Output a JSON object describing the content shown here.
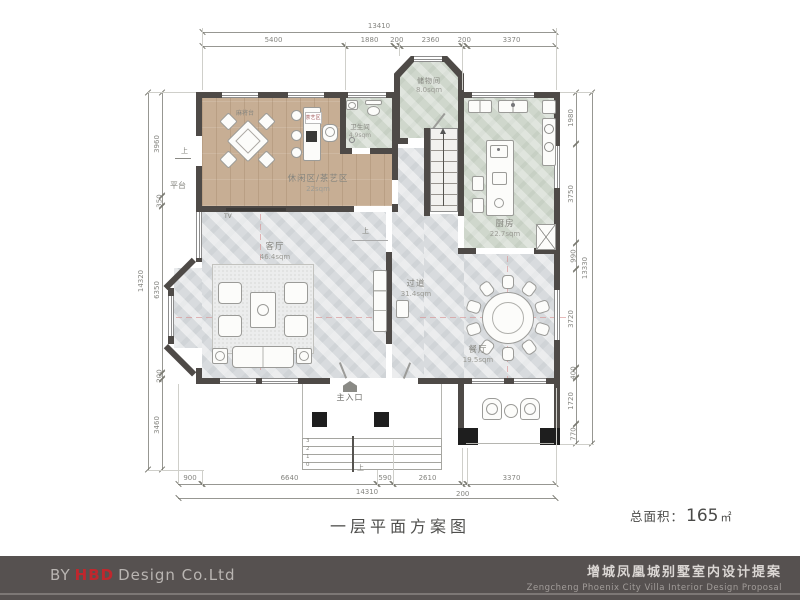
{
  "plan": {
    "title": "一层平面方案图",
    "total_area": {
      "label": "总面积：",
      "value": "165",
      "unit": "㎡"
    },
    "rooms": {
      "leisure": {
        "name": "休闲区/茶艺区",
        "area": "22sqm"
      },
      "storage": {
        "name": "储物间",
        "area": "8.0sqm"
      },
      "bathroom": {
        "name": "卫生间",
        "area": "4.9sqm"
      },
      "kitchen": {
        "name": "厨房",
        "area": "22.7sqm"
      },
      "living": {
        "name": "客厅",
        "area": "46.4sqm"
      },
      "hallway": {
        "name": "过道",
        "area": "31.4sqm"
      },
      "dining": {
        "name": "餐厅",
        "area": "19.5sqm"
      }
    },
    "labels": {
      "main_entrance": "主入口",
      "platform": "平台",
      "up": "上",
      "tv": "TV",
      "mahjong_table": "麻将台",
      "tea_bar": "茶艺区",
      "steps": [
        "3",
        "2",
        "1",
        "0"
      ]
    },
    "dimensions": {
      "top_total": "13410",
      "top": [
        "5400",
        "1880",
        "200",
        "2360",
        "200",
        "3370"
      ],
      "bottom": [
        "900",
        "6640",
        "590",
        "2610",
        "200",
        "3370"
      ],
      "bottom_total": "14310",
      "left": [
        "3960",
        "350",
        "6350",
        "200",
        "3460"
      ],
      "left_total": "14320",
      "right": [
        "1980",
        "3750",
        "990",
        "3720",
        "400",
        "1720",
        "770"
      ],
      "right_total": "13330"
    },
    "colors": {
      "wall": "#4e4a47",
      "wood_floor": "#c7ae94",
      "marble_green": "#cfd7cc",
      "marble_gray": "#d8dbde",
      "accent_red": "#c0272d",
      "footer_bg": "#565150"
    }
  },
  "footer": {
    "by": "BY",
    "brand": "HBD",
    "brand_rest": "Design Co.Ltd",
    "project_cn": "增城凤凰城别墅室内设计提案",
    "project_en": "Zengcheng Phoenix City Villa Interior Design Proposal"
  }
}
